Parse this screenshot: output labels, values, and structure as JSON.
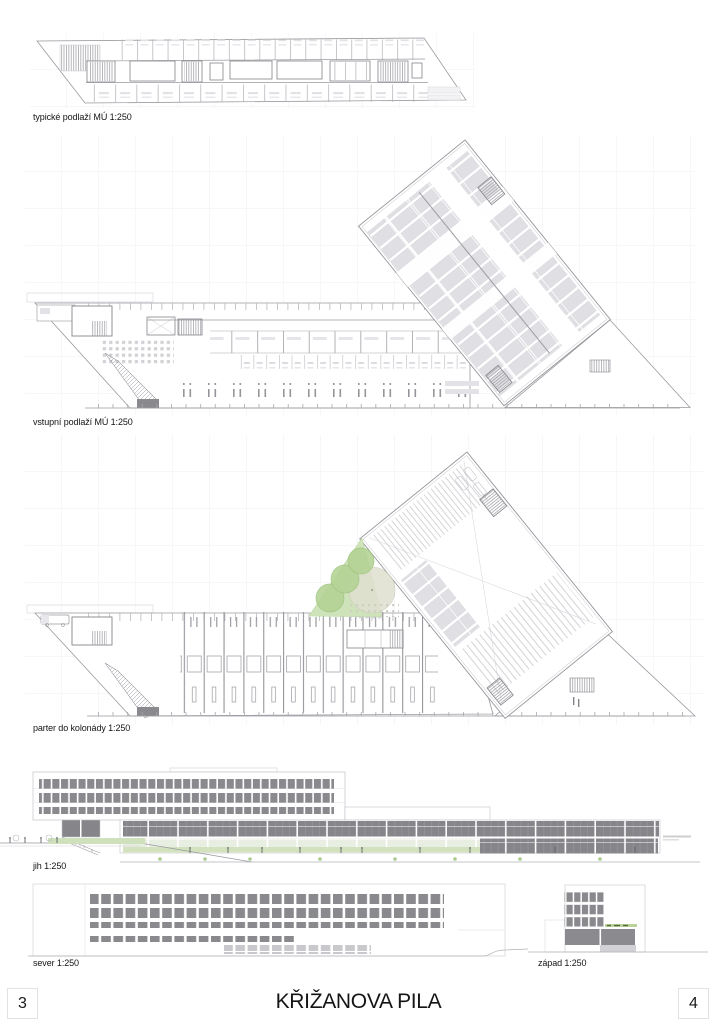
{
  "document": {
    "title": "KŘIŽANOVA PILA",
    "page_number_left": "3",
    "page_number_right": "4"
  },
  "figures": {
    "typical_floor": {
      "label": "typické podlaží MÚ 1:250"
    },
    "entry_floor": {
      "label": "vstupní podlaží MÚ 1:250"
    },
    "ground_colonnade": {
      "label": "parter do kolonády 1:250"
    },
    "south_elevation": {
      "label": "jih 1:250"
    },
    "north_elevation": {
      "label": "sever 1:250"
    },
    "west_elevation": {
      "label": "západ 1:250"
    }
  },
  "colors": {
    "drawing_line": "#9a9aa0",
    "light_line": "#c9c9ce",
    "window_gray": "#8a8a8e",
    "panel_gray": "#85858a",
    "stall_fill": "#e0e0e4",
    "green_area": "#cfe3ba",
    "tree_green": "#b5d395",
    "ground_green": "#d9e8c9",
    "grid": "#edeff1"
  }
}
